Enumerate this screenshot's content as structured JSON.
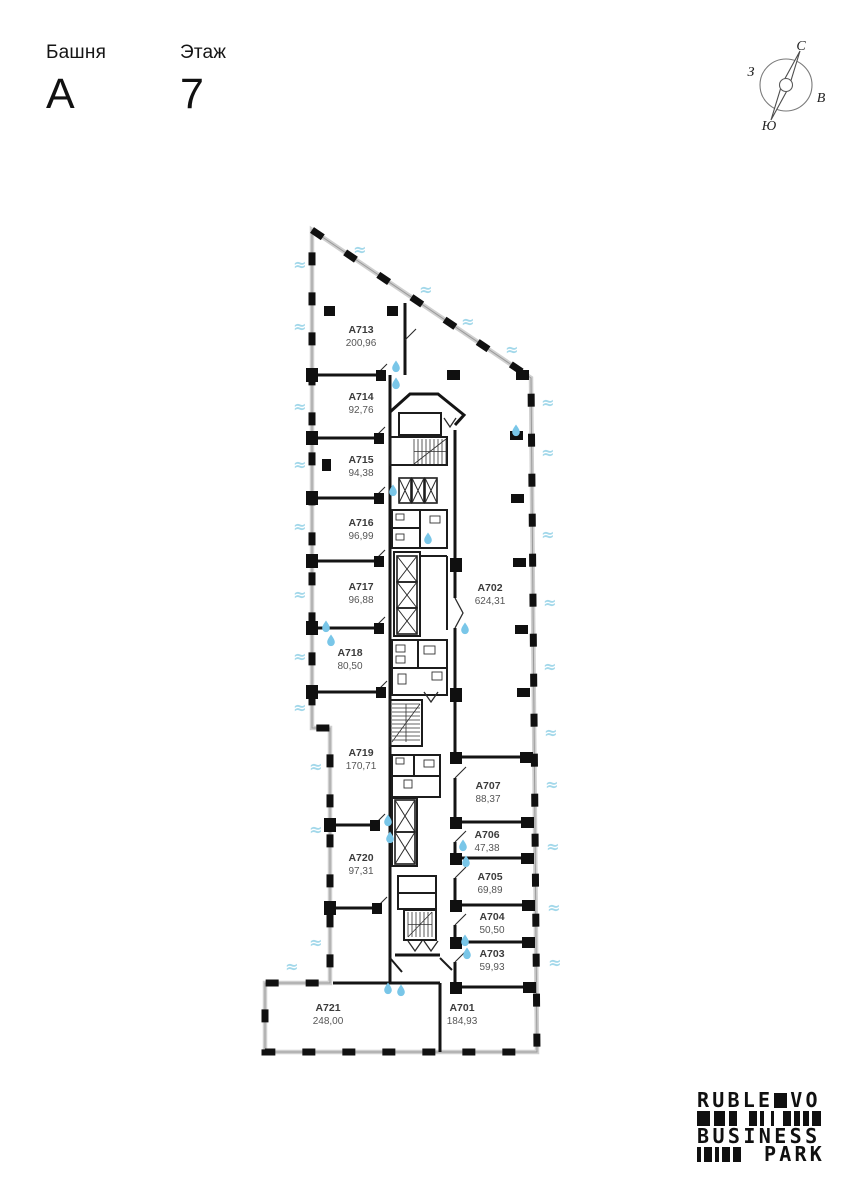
{
  "header": {
    "tower_label": "Башня",
    "tower_value": "А",
    "floor_label": "Этаж",
    "floor_value": "7"
  },
  "compass": {
    "north": "С",
    "south": "Ю",
    "east": "В",
    "west": "З"
  },
  "plan": {
    "rooms": [
      {
        "id": "А701",
        "area": "184,93"
      },
      {
        "id": "А702",
        "area": "624,31"
      },
      {
        "id": "А703",
        "area": "59,93"
      },
      {
        "id": "А704",
        "area": "50,50"
      },
      {
        "id": "А705",
        "area": "69,89"
      },
      {
        "id": "А706",
        "area": "47,38"
      },
      {
        "id": "А707",
        "area": "88,37"
      },
      {
        "id": "А713",
        "area": "200,96"
      },
      {
        "id": "А714",
        "area": "92,76"
      },
      {
        "id": "А715",
        "area": "94,38"
      },
      {
        "id": "А716",
        "area": "96,99"
      },
      {
        "id": "А717",
        "area": "96,88"
      },
      {
        "id": "А718",
        "area": "80,50"
      },
      {
        "id": "А719",
        "area": "170,71"
      },
      {
        "id": "А720",
        "area": "97,31"
      },
      {
        "id": "А721",
        "area": "248,00"
      }
    ],
    "icons": {
      "window_glyph": "≈",
      "window_color": "#a3d8ea",
      "drop_color": "#79c6e8"
    },
    "wall_color": "#141414"
  },
  "logo": {
    "line1_left": "RUBLE",
    "line1_right": "VO",
    "line3": "BUSINESS",
    "line4_text": "PARK",
    "barcode_row1": [
      [
        13,
        4
      ],
      [
        11,
        4
      ],
      [
        8,
        12
      ],
      [
        8,
        3
      ],
      [
        4,
        7
      ],
      [
        3,
        9
      ],
      [
        8,
        3
      ],
      [
        6,
        3
      ],
      [
        6,
        3
      ],
      [
        9,
        0
      ]
    ],
    "barcode_row2": [
      [
        4,
        3
      ],
      [
        8,
        3
      ],
      [
        4,
        3
      ],
      [
        8,
        3
      ],
      [
        8,
        0
      ]
    ]
  }
}
